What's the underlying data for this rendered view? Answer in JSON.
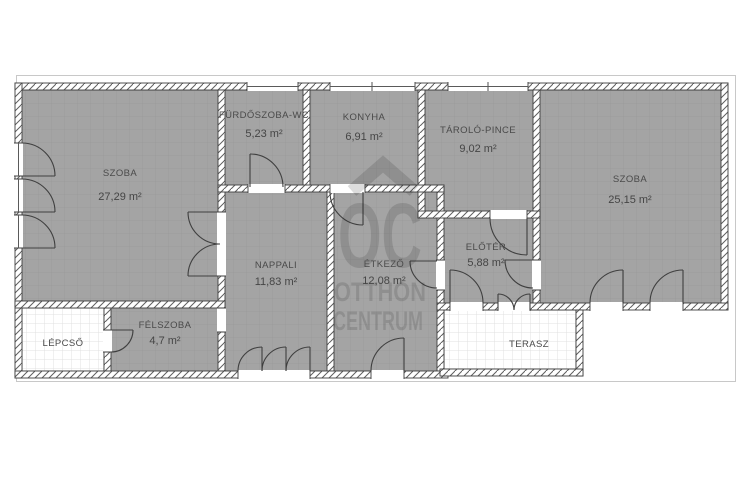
{
  "watermark": {
    "brand_initials": "OC",
    "brand_line1": "OTTHON",
    "brand_line2": "CENTRUM"
  },
  "rooms": {
    "szoba1": {
      "name": "SZOBA",
      "area": "27,29 m²"
    },
    "furdo": {
      "name": "FÜRDŐSZOBA-WC",
      "area": "5,23 m²"
    },
    "konyha": {
      "name": "KONYHA",
      "area": "6,91 m²"
    },
    "tarolo": {
      "name": "TÁROLÓ-PINCE",
      "area": "9,02 m²"
    },
    "szoba2": {
      "name": "SZOBA",
      "area": "25,15 m²"
    },
    "nappali": {
      "name": "NAPPALI",
      "area": "11,83 m²"
    },
    "etkezo": {
      "name": "ÉTKEZŐ",
      "area": "12,08 m²"
    },
    "eloter": {
      "name": "ELŐTÉR",
      "area": "5,88 m²"
    },
    "felszoba": {
      "name": "FÉLSZOBA",
      "area": "4,7 m²"
    },
    "lepcso": {
      "name": "LÉPCSŐ"
    },
    "terasz": {
      "name": "TERASZ"
    }
  }
}
